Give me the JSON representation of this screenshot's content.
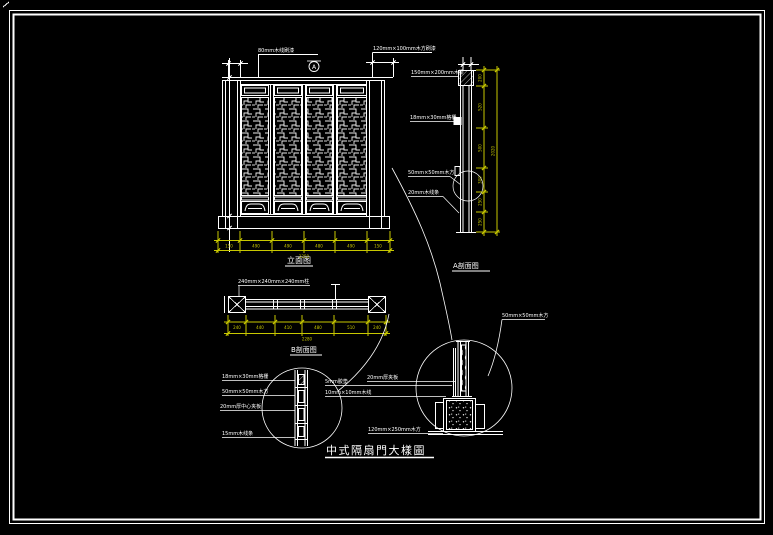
{
  "drawing_title": {
    "text": "中式隔扇門大樣圖"
  },
  "view_labels": {
    "elevation": "立面图",
    "section_a": "A剖面图",
    "section_b": "B剖面图"
  },
  "section_marker": {
    "letter": "A"
  },
  "annotations": {
    "elev_top_left": "80mm木线刷漆",
    "elev_top_right": "120mm×100mm木方刷漆",
    "sa_beam": "150mm×200mm木梁",
    "sa_lattice": "18mm×30mm格栅",
    "sa_block": "50mm×50mm木方",
    "sa_trim": "20mm木线条",
    "sb_post": "240mm×240mm×240mm柱",
    "ld_lattice": "18mm×30mm格栅",
    "ld_block": "50mm×50mm木方",
    "ld_core": "20mm厚中心夹板",
    "ld_trim": "15mm木线条",
    "rd_pad": "5mm胶垫",
    "rd_line": "10mm×10mm木线",
    "rd_board": "20mm厚夹板",
    "rd_base": "120mm×250mm木方",
    "rd_block": "50mm×50mm木方"
  },
  "dimensions": {
    "elevation_bottom": {
      "segments": [
        "150",
        "490",
        "490",
        "480",
        "490",
        "150"
      ],
      "total": "2250"
    },
    "section_a_right": {
      "segments": [
        "200",
        "520",
        "500",
        "300",
        "250",
        "250"
      ],
      "total": "2020"
    },
    "section_b_bottom": {
      "segments": [
        "240",
        "440",
        "410",
        "480",
        "510",
        "240"
      ],
      "total": "2280"
    }
  },
  "colors": {
    "background": "#000000",
    "linework": "#ffffff",
    "dimension": "#c8c800"
  }
}
